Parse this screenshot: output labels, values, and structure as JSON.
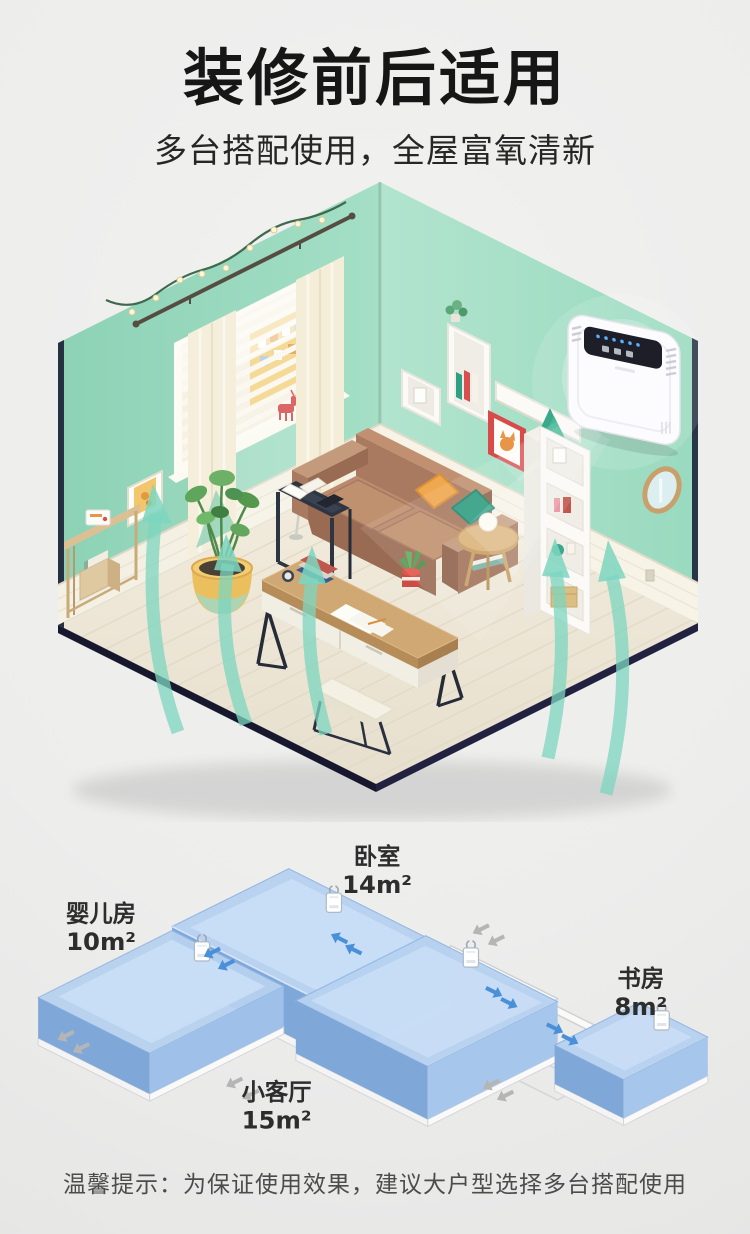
{
  "page": {
    "background": "#ededec"
  },
  "header": {
    "title": "装修前后适用",
    "subtitle": "多台搭配使用，全屋富氧清新",
    "text_color": "#161616"
  },
  "room_scene": {
    "wall_color": "#9edcc4",
    "wainscot_color": "#f4f0e4",
    "floor_color": "#efe8d9",
    "platform_edge_color": "#17172e",
    "sofa_color": "#ab7a5f",
    "pillow_colors": [
      "#f0a84e",
      "#2f9e82"
    ],
    "airflow_arrow_color": "#7dd6c0",
    "plant_pot_color": "#ecbf5e",
    "purifier": {
      "body_color": "#fcfcfe",
      "screen_color": "#1e1e28",
      "indicator_color": "#58b0ff"
    }
  },
  "floor_plan": {
    "rooms": [
      {
        "name": "婴儿房",
        "area": "10m²"
      },
      {
        "name": "卧室",
        "area": "14m²"
      },
      {
        "name": "书房",
        "area": "8m²"
      },
      {
        "name": "小客厅",
        "area": "15m²"
      }
    ],
    "room_top_color": "#b7d2f0",
    "room_wall_left_color": "#7fa8d9",
    "room_wall_right_color": "#a7c6eb",
    "inflow_arrow_color": "#4a90d9",
    "outflow_arrow_color": "#b5b5b5",
    "label_color": "#2d2d2d"
  },
  "footer": {
    "tip": "温馨提示：为保证使用效果，建议大户型选择多台搭配使用",
    "text_color": "#4c4c4c"
  }
}
